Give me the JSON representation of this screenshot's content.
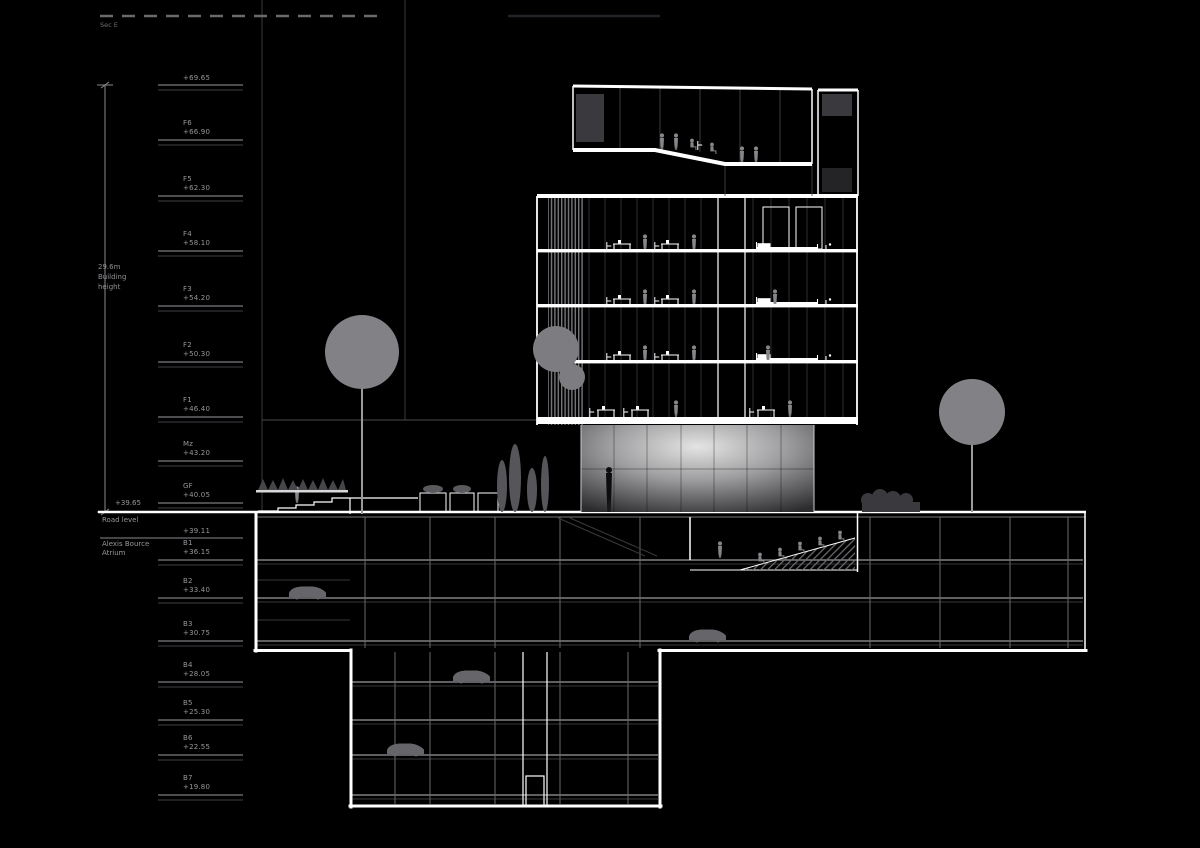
{
  "drawing": {
    "title": "Sec E",
    "scale_bar_label": "Sec E",
    "dimension": {
      "line1": "29.6m",
      "line2": "Building",
      "line3": "height"
    },
    "road": {
      "label": "Road level",
      "value": "+39.65"
    },
    "atrium": {
      "label_line1": "Alexis Bource",
      "label_line2": "Atrium",
      "value": "+39.11"
    },
    "levels": [
      {
        "name": "",
        "value": "+69.65",
        "y": 85,
        "double": true
      },
      {
        "name": "F6",
        "value": "+66.90",
        "y": 140,
        "double": true
      },
      {
        "name": "F5",
        "value": "+62.30",
        "y": 196,
        "double": true
      },
      {
        "name": "F4",
        "value": "+58.10",
        "y": 251,
        "double": true
      },
      {
        "name": "F3",
        "value": "+54.20",
        "y": 306,
        "double": true
      },
      {
        "name": "F2",
        "value": "+50.30",
        "y": 362,
        "double": true
      },
      {
        "name": "F1",
        "value": "+46.40",
        "y": 417,
        "double": true
      },
      {
        "name": "Mz",
        "value": "+43.20",
        "y": 461,
        "double": true
      },
      {
        "name": "GF",
        "value": "+40.05",
        "y": 503,
        "double": true
      },
      {
        "name": "",
        "value": "+39.11",
        "y": 538,
        "double": false
      },
      {
        "name": "B1",
        "value": "+36.15",
        "y": 560,
        "double": true
      },
      {
        "name": "B2",
        "value": "+33.40",
        "y": 598,
        "double": true
      },
      {
        "name": "B3",
        "value": "+30.75",
        "y": 641,
        "double": true
      },
      {
        "name": "B4",
        "value": "+28.05",
        "y": 682,
        "double": true
      },
      {
        "name": "B5",
        "value": "+25.30",
        "y": 720,
        "double": true
      },
      {
        "name": "B6",
        "value": "+22.55",
        "y": 755,
        "double": true
      },
      {
        "name": "B7",
        "value": "+19.80",
        "y": 795,
        "double": true
      }
    ],
    "colors": {
      "background": "#000000",
      "line_white": "#ffffff",
      "line_gray": "#9a9a9e",
      "line_faint": "#4a4a4d",
      "text_gray": "#97979b",
      "tree_gray": "#828286",
      "figure_gray": "#85858a",
      "dark_window": "#3a3a3e"
    }
  }
}
